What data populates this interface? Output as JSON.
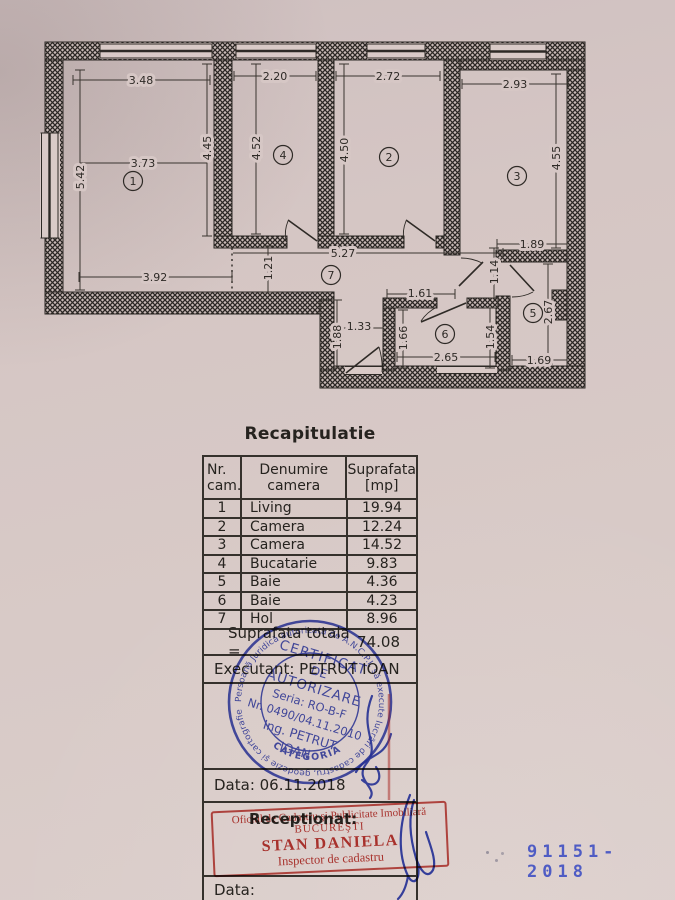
{
  "plan": {
    "room_numbers": {
      "r1": "1",
      "r2": "2",
      "r3": "3",
      "r4": "4",
      "r5": "5",
      "r6": "6",
      "r7": "7"
    },
    "dims": {
      "r1_top": "3.48",
      "r1_mid": "3.73",
      "r1_right": "4.45",
      "r1_left": "5.42",
      "r1_bottom": "3.92",
      "r4_top": "2.20",
      "r4_left": "4.52",
      "r2_top": "2.72",
      "r2_left": "4.50",
      "r3_top": "2.93",
      "r3_right": "4.55",
      "hall_width": "5.27",
      "hall_depth": "1.21",
      "vest_width": "1.33",
      "vest_depth": "1.88",
      "r6_top": "1.61",
      "r6_left": "1.66",
      "r6_bottom": "2.65",
      "r6_right": "1.54",
      "r5_top": "1.89",
      "r5_pass": "1.14",
      "r5_right": "2.67",
      "r5_bottom": "1.69"
    }
  },
  "recap": {
    "title": "Recapitulatie",
    "headers": {
      "col1_l1": "Nr.",
      "col1_l2": "cam.",
      "col2_l1": "Denumire",
      "col2_l2": "camera",
      "col3_l1": "Suprafata",
      "col3_l2": "[mp]"
    },
    "rows": [
      {
        "nr": "1",
        "name": "Living",
        "area": "19.94"
      },
      {
        "nr": "2",
        "name": "Camera",
        "area": "12.24"
      },
      {
        "nr": "3",
        "name": "Camera",
        "area": "14.52"
      },
      {
        "nr": "4",
        "name": "Bucatarie",
        "area": "9.83"
      },
      {
        "nr": "5",
        "name": "Baie",
        "area": "4.36"
      },
      {
        "nr": "6",
        "name": "Baie",
        "area": "4.23"
      },
      {
        "nr": "7",
        "name": "Hol",
        "area": "8.96"
      }
    ],
    "total_label": "Suprafata totala =",
    "total_value": "74.08"
  },
  "sections": {
    "executant": "Executant: PETRUT IOAN",
    "data1": "Data: 06.11.2018",
    "receptionat": "Receptionat:",
    "data2": "Data:"
  },
  "blue_stamp": {
    "ring_text": "Persoană Juridică autorizată de A.N.C.P.I. să execute lucrări de cadastru, geodezie şi cartografie",
    "category": "CATEGORIA A",
    "line1": "CERTIFICAT",
    "line2": "DE",
    "line3": "AUTORIZARE",
    "line4": "Seria: RO-B-F",
    "line5": "Nr. 0490/04.11.2010",
    "line6": "Ing. PETRUT",
    "line7": "IOAN"
  },
  "red_stamp": {
    "line1": "Oficiul de Cadastru şi Publicitate Imobiliară",
    "line2": "BUCUREŞTI",
    "line3": "STAN DANIELA",
    "line4": "Inspector de cadastru"
  },
  "registry_number": "91151-2018",
  "colors": {
    "stamp_blue": "#3946bb",
    "stamp_red": "#c23c36",
    "registry_blue": "#4353c4",
    "paper": "#d6c7c5"
  }
}
